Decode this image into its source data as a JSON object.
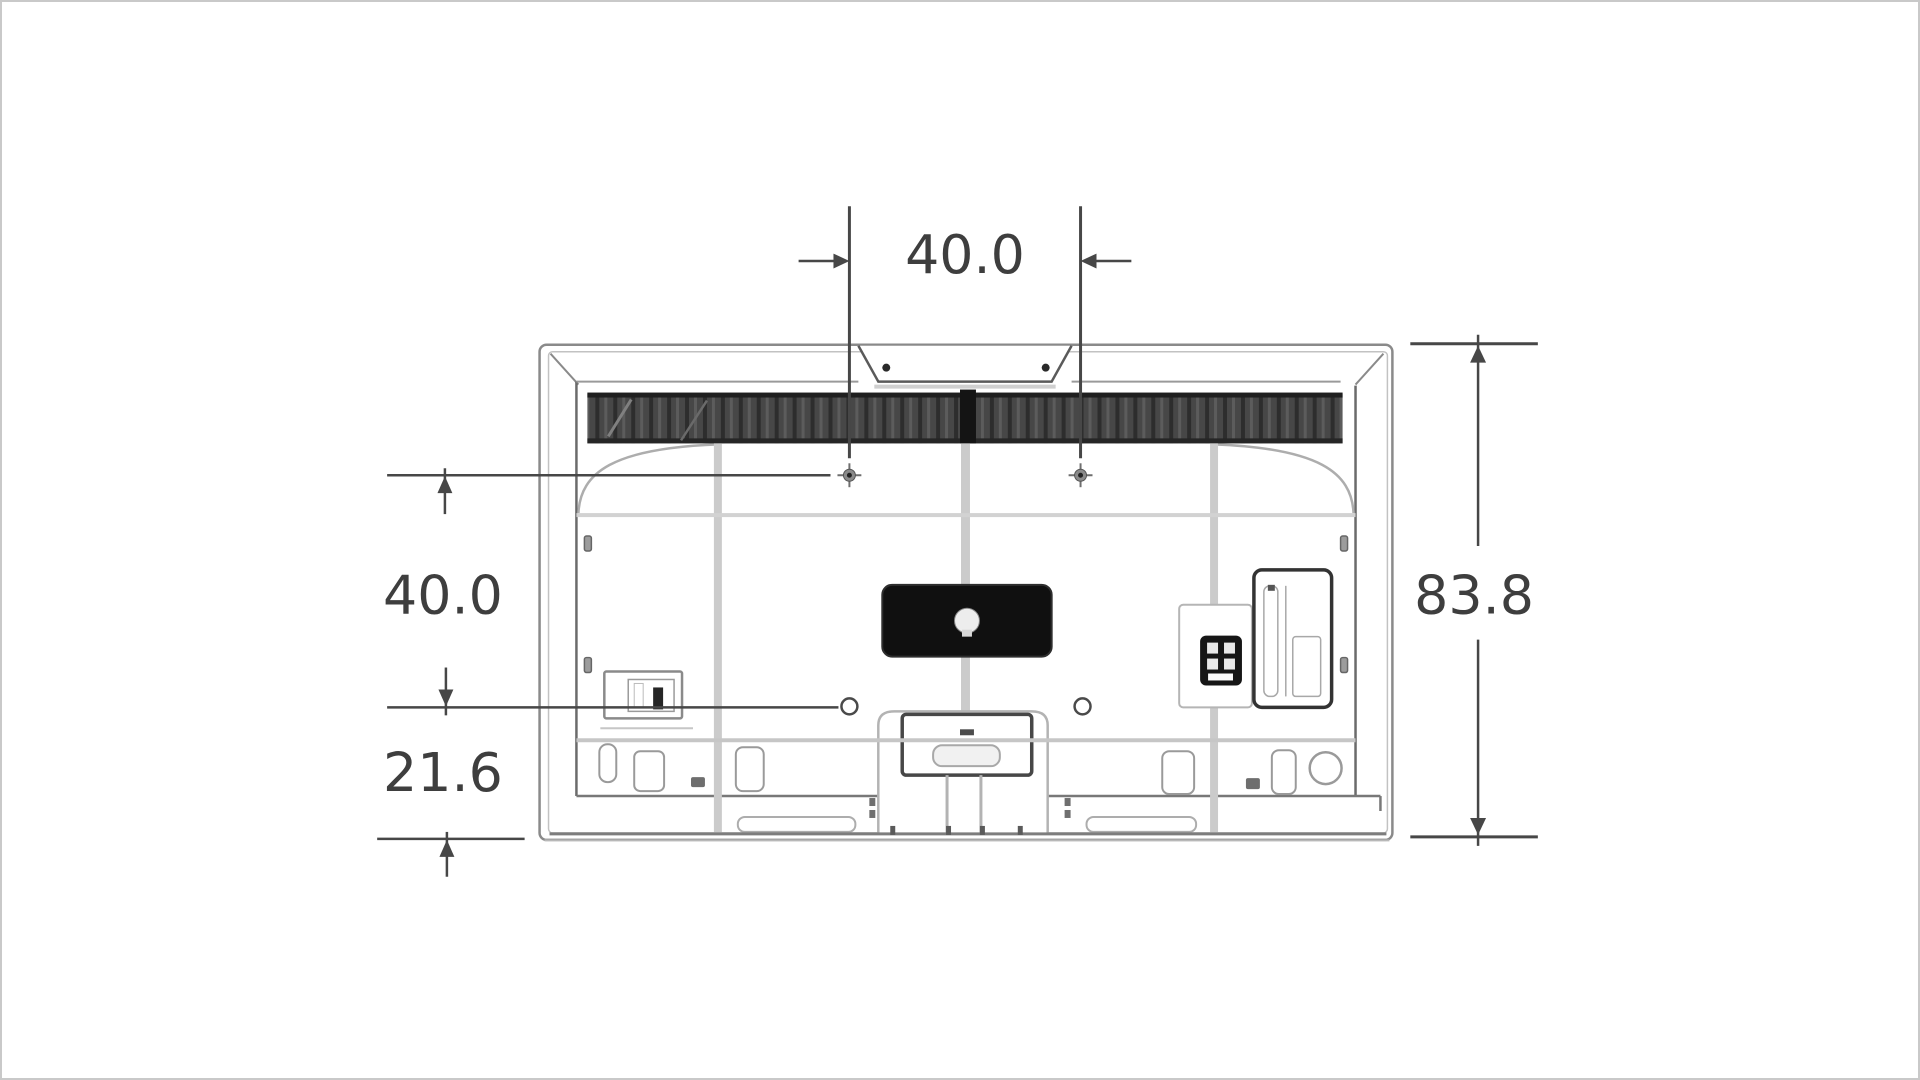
{
  "diagram": {
    "subject": "tv-rear-view-dimension-drawing",
    "dimensions": {
      "vesa_width": "40.0",
      "vesa_height": "40.0",
      "bottom_offset": "21.6",
      "overall_height": "83.8"
    },
    "colors": {
      "dimension_lines": "#474747",
      "label_text": "#3e3e3e",
      "tv_outline": "#8a8a8a",
      "speaker_grille": "#474747",
      "io_box": "#101010",
      "page_border": "#c9c9c9",
      "background": "#ffffff"
    }
  }
}
